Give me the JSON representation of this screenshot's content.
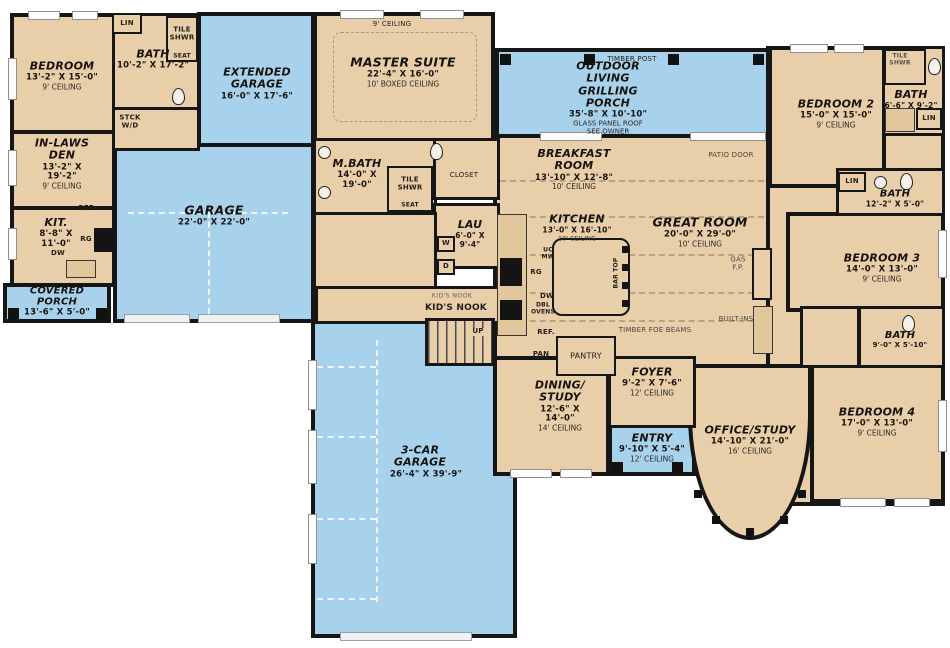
{
  "colors": {
    "room_fill": "#e8cfaa",
    "porch_fill": "#a8d1ec",
    "wall": "#161616"
  },
  "rooms": {
    "bedroom1": {
      "name": "BEDROOM",
      "dims": "13'-2\" X 15'-0\"",
      "ceiling": "9' CEILING"
    },
    "bath1": {
      "name": "BATH",
      "dims": "10'-2\" X 17'-2\""
    },
    "inlaws_den": {
      "name": "IN-LAWS DEN",
      "dims": "13'-2\" X 19'-2\"",
      "ceiling": "9' CEILING"
    },
    "kit": {
      "name": "KIT.",
      "dims": "8'-8\" X 11'-0\""
    },
    "covered_porch": {
      "name": "COVERED PORCH",
      "dims": "13'-6\" X 5'-0\""
    },
    "extended_garage": {
      "name": "EXTENDED GARAGE",
      "dims": "16'-0\" X 17'-6\""
    },
    "garage": {
      "name": "GARAGE",
      "dims": "22'-0\" X 22'-0\""
    },
    "master_suite": {
      "name": "MASTER SUITE",
      "dims": "22'-4\" X 16'-0\"",
      "ceiling": "10' BOXED CEILING"
    },
    "mbath": {
      "name": "M.BATH",
      "dims": "14'-0\" X 19'-0\""
    },
    "lau": {
      "name": "LAU",
      "dims": "6'-0\" X 9'-4\""
    },
    "outdoor_living": {
      "name": "OUTDOOR LIVING GRILLING PORCH",
      "dims": "35'-8\" X 10'-10\"",
      "note1": "GLASS PANEL ROOF",
      "note2": "SEE OWNER"
    },
    "breakfast": {
      "name": "BREAKFAST ROOM",
      "dims": "13'-10\" X 12'-8\"",
      "ceiling": "10' CEILING"
    },
    "kitchen": {
      "name": "KITCHEN",
      "dims": "13'-0\" X 16'-10\"",
      "ceiling": "10' CEILING"
    },
    "great_room": {
      "name": "GREAT ROOM",
      "dims": "20'-0\" X 29'-0\"",
      "ceiling": "10' CEILING"
    },
    "bedroom2": {
      "name": "BEDROOM 2",
      "dims": "15'-0\" X 15'-0\"",
      "ceiling": "9' CEILING"
    },
    "bath2": {
      "name": "BATH",
      "dims": "6'-6\" X 9'-2\""
    },
    "bath3": {
      "name": "BATH",
      "dims": "12'-2\" X 5'-0\""
    },
    "bedroom3": {
      "name": "BEDROOM 3",
      "dims": "14'-0\" X 13'-0\"",
      "ceiling": "9' CEILING"
    },
    "bath4": {
      "name": "BATH",
      "dims": "9'-0\" X 5'-10\""
    },
    "bedroom4": {
      "name": "BEDROOM 4",
      "dims": "17'-0\" X 13'-0\"",
      "ceiling": "9' CEILING"
    },
    "office_study": {
      "name": "OFFICE/STUDY",
      "dims": "14'-10\" X 21'-0\"",
      "ceiling": "16' CEILING"
    },
    "dining_study": {
      "name": "DINING/ STUDY",
      "dims": "12'-6\" X 14'-0\"",
      "ceiling": "14' CEILING"
    },
    "foyer": {
      "name": "FOYER",
      "dims": "9'-2\" X 7'-6\"",
      "ceiling": "12' CEILING"
    },
    "entry": {
      "name": "ENTRY",
      "dims": "9'-10\" X 5'-4\"",
      "ceiling": "12' CEILING"
    },
    "car_garage": {
      "name": "3-CAR GARAGE",
      "dims": "26'-4\" X 39'-9\""
    }
  },
  "fixtures": {
    "lin": "LIN",
    "tile_shwr": "TILE SHWR",
    "seat": "SEAT",
    "stck_wd": "STCK W/D",
    "ref": "REF",
    "ref_main": "REF.",
    "rg": "RG",
    "dw": "DW",
    "uc_mw": "UC MW",
    "dbl_ovens": "DBL OVENS",
    "pan": "PAN",
    "pantry": "PANTRY",
    "closet": "CLOSET",
    "washer": "W",
    "dryer": "D",
    "up": "UP",
    "kids_nook": "KID'S NOOK",
    "timber_post": "TIMBER POST",
    "patio_door": "PATIO DOOR",
    "gas_fp": "GAS F.P.",
    "built_ins": "BUILT-INS",
    "timber_beams": "TIMBER FOE BEAMS",
    "bar_top": "BAR TOP",
    "ceiling_9": "9' CEILING"
  }
}
